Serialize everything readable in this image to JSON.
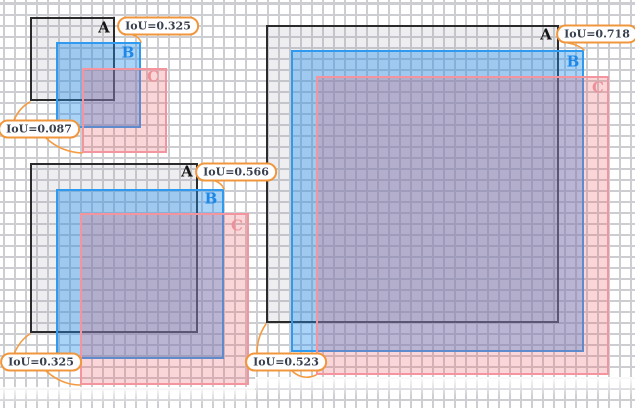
{
  "colors": {
    "grid_line": "#cdced2",
    "background": "#ffffff",
    "box_a_border": "#2b2b2b",
    "box_b_border": "#2e9af0",
    "box_c_border": "#f3949e",
    "label_a": "#151515",
    "label_b": "#1d88e8",
    "label_c": "#ee9098",
    "badge_border": "#f0963c",
    "badge_text": "#39404f",
    "leader_line": "#f59b42"
  },
  "diagram": {
    "kind": "iou-overlap-illustration",
    "groups": [
      {
        "name": "small-example",
        "boxes": [
          {
            "key": "A",
            "label": "A",
            "x": 30,
            "y": 17,
            "w": 85,
            "h": 84,
            "lx": 104,
            "ly": 28
          },
          {
            "key": "B",
            "label": "B",
            "x": 56,
            "y": 42,
            "w": 85,
            "h": 86,
            "lx": 128,
            "ly": 53
          },
          {
            "key": "C",
            "label": "C",
            "x": 82,
            "y": 68,
            "w": 85,
            "h": 85,
            "lx": 153,
            "ly": 77
          }
        ],
        "badges": [
          {
            "text": "IoU=0.325",
            "cx": 158,
            "cy": 26
          },
          {
            "text": "IoU=0.087",
            "cx": 39,
            "cy": 129
          }
        ],
        "leaders": [
          "M133,35 Q139,37 141,42",
          "M30,102 Q20,107 14,120",
          "M46,138 Q61,152 82,153"
        ]
      },
      {
        "name": "medium-example",
        "boxes": [
          {
            "key": "A",
            "label": "A",
            "x": 30,
            "y": 163,
            "w": 168,
            "h": 170,
            "lx": 187,
            "ly": 172
          },
          {
            "key": "B",
            "label": "B",
            "x": 56,
            "y": 189,
            "w": 168,
            "h": 170,
            "lx": 211,
            "ly": 199
          },
          {
            "key": "C",
            "label": "C",
            "x": 80,
            "y": 213,
            "w": 169,
            "h": 172,
            "lx": 237,
            "ly": 226
          }
        ],
        "badges": [
          {
            "text": "IoU=0.566",
            "cx": 236,
            "cy": 172
          },
          {
            "text": "IoU=0.325",
            "cx": 41,
            "cy": 362
          }
        ],
        "leaders": [
          "M212,180 Q221,182 224,189",
          "M30,334 Q20,340 14,354",
          "M46,371 Q62,385 80,385"
        ]
      },
      {
        "name": "large-example",
        "boxes": [
          {
            "key": "A",
            "label": "A",
            "x": 266,
            "y": 25,
            "w": 293,
            "h": 298,
            "lx": 546,
            "ly": 35
          },
          {
            "key": "B",
            "label": "B",
            "x": 291,
            "y": 50,
            "w": 293,
            "h": 302,
            "lx": 573,
            "ly": 62
          },
          {
            "key": "C",
            "label": "C",
            "x": 316,
            "y": 76,
            "w": 293,
            "h": 299,
            "lx": 598,
            "ly": 88
          }
        ],
        "badges": [
          {
            "text": "IoU=0.718",
            "cx": 597,
            "cy": 34
          },
          {
            "text": "IoU=0.523",
            "cx": 286,
            "cy": 362
          }
        ],
        "leaders": [
          "M568,43 Q579,45 584,50",
          "M266,324 Q257,337 257,353",
          "M292,371 Q303,381 316,375"
        ]
      }
    ]
  }
}
